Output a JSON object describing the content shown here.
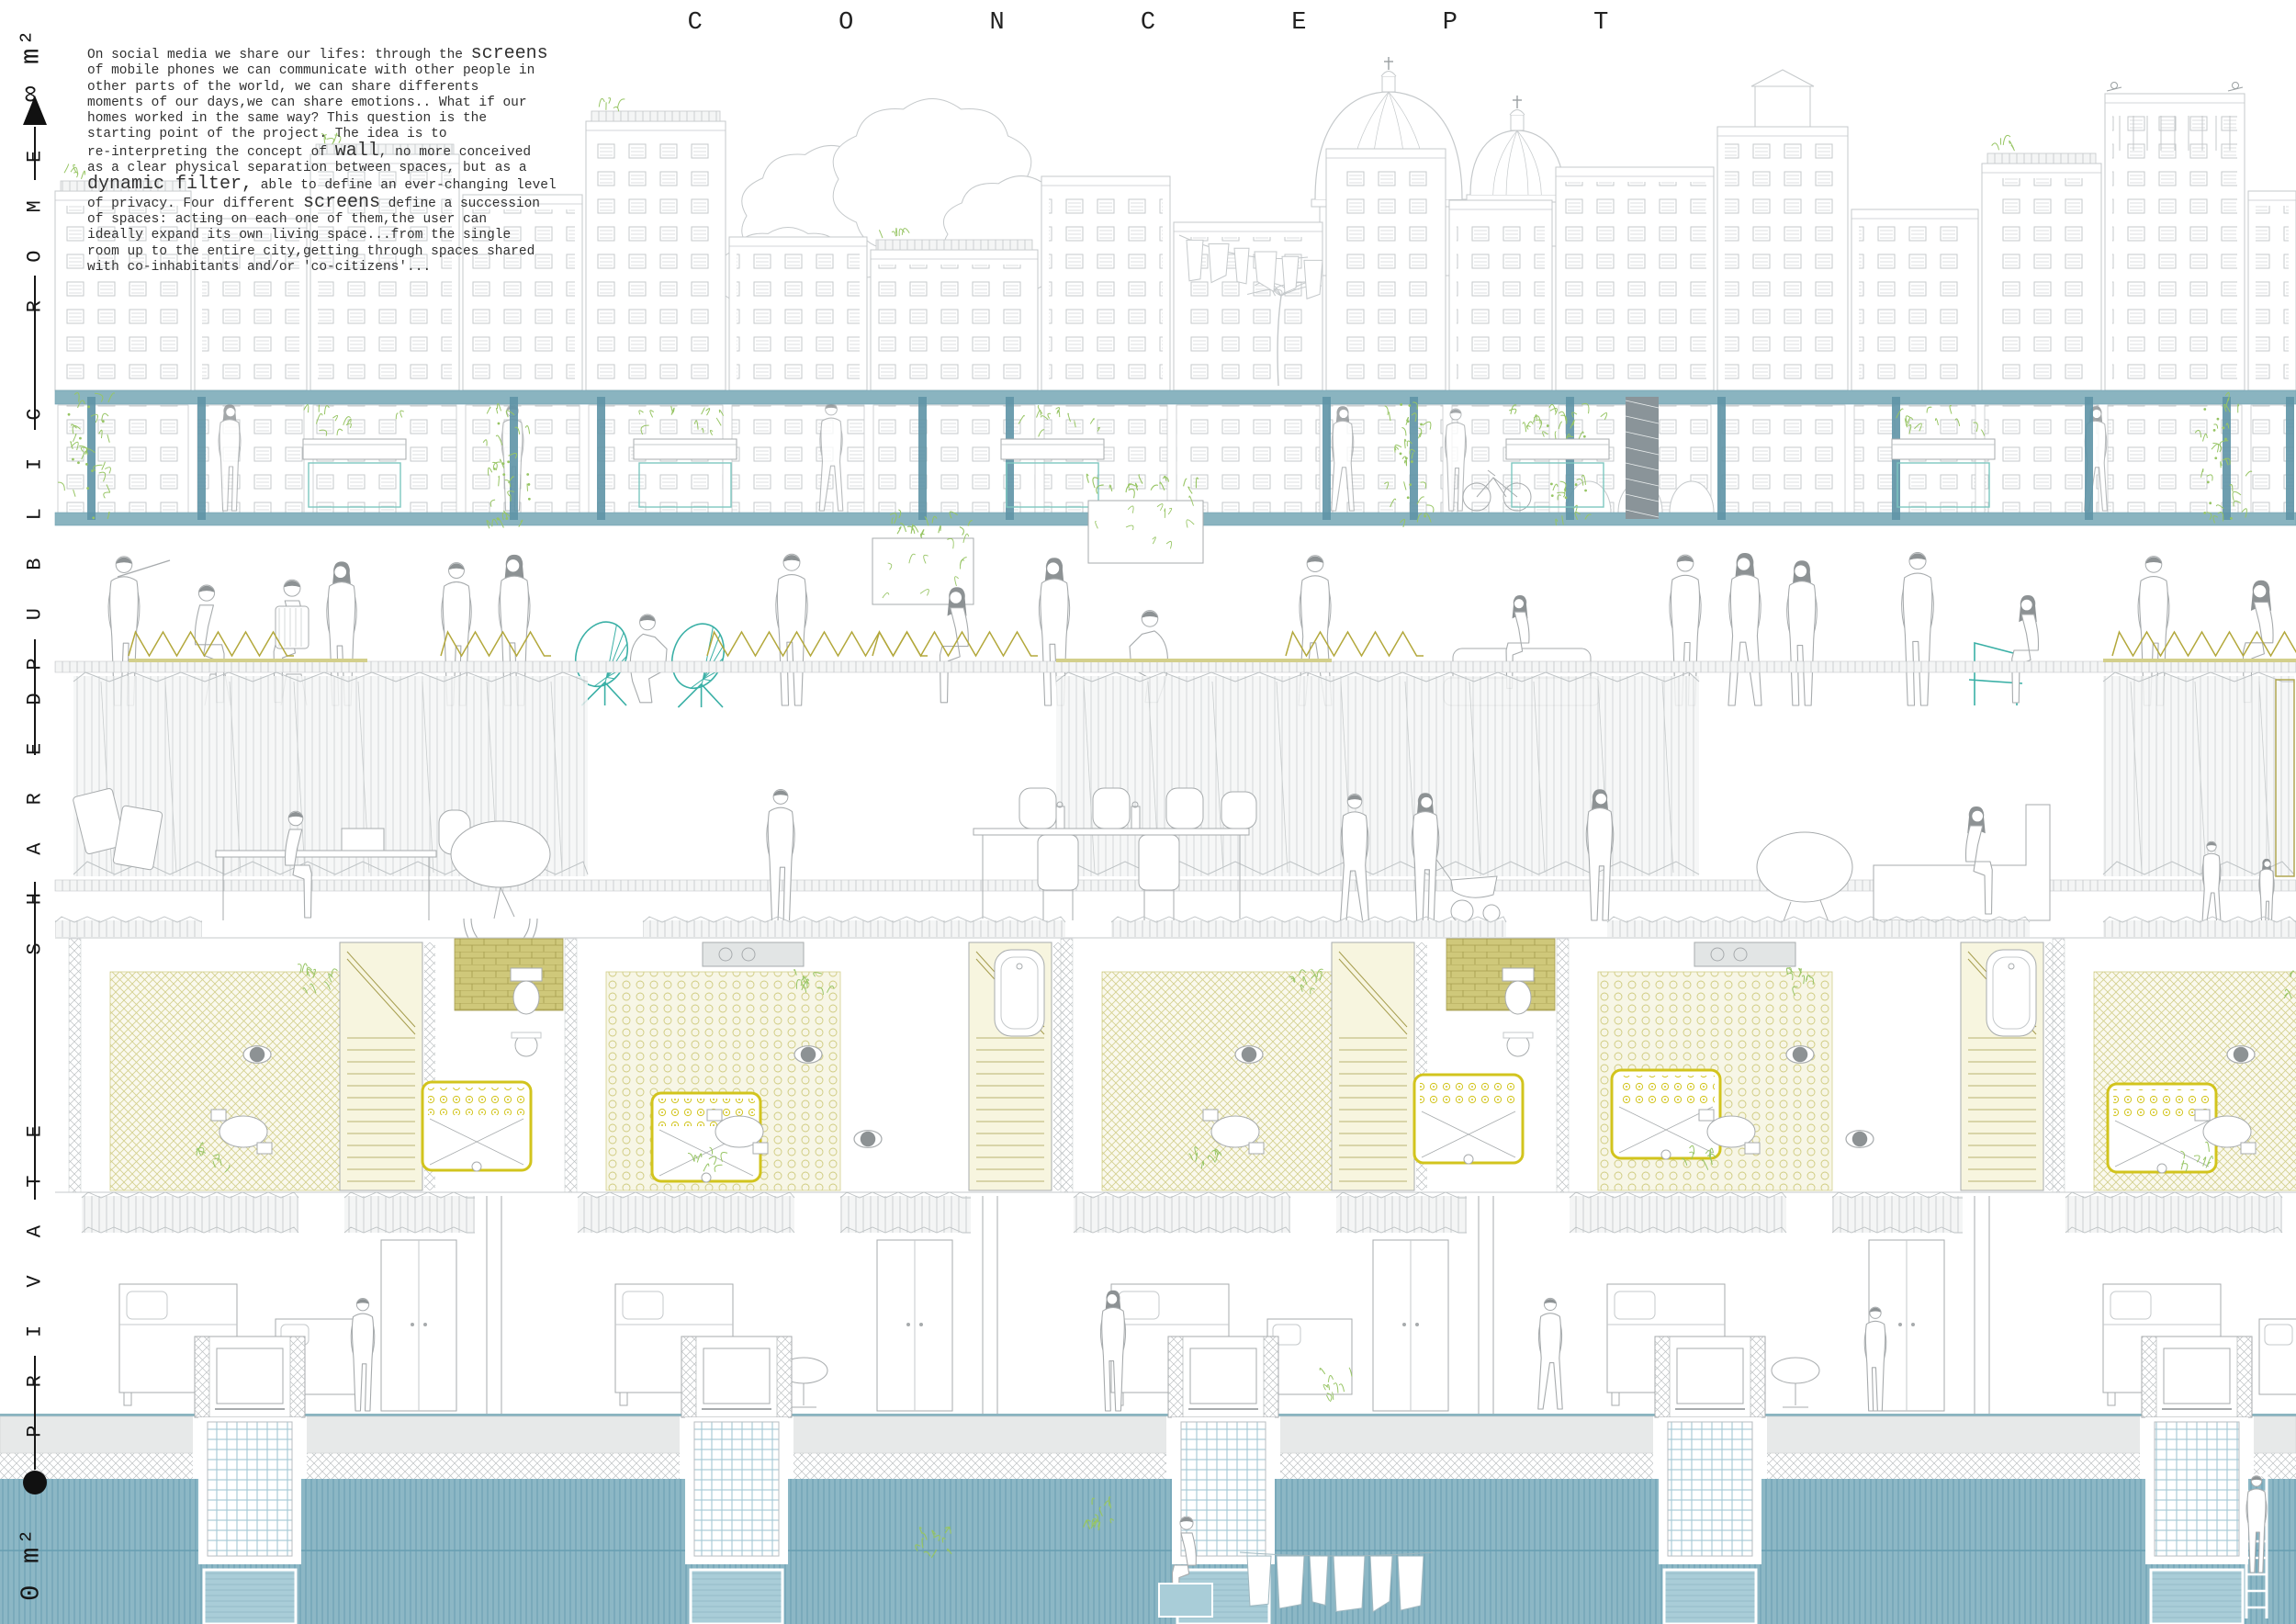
{
  "title": "C O N C E P T",
  "axis": {
    "infinity_label": "∞ m²",
    "zero_label": "0 m²",
    "levels": [
      "R O M E",
      "P U B L I C",
      "S H A R E D",
      "P R I V A T E"
    ]
  },
  "concept_text": {
    "segments": [
      {
        "text": "On social media we share our lifes: through the ",
        "big": false
      },
      {
        "text": "screens",
        "big": true
      },
      {
        "text": "\nof mobile phones we can communicate with other people in\nother parts of the world, we can share differents\nmoments of our days,we can share emotions.. What if our\nhomes worked in the same way? This question is the\nstarting point of the project. The idea is to\nre-interpreting the concept of ",
        "big": false
      },
      {
        "text": "wall",
        "big": true
      },
      {
        "text": ", no more conceived\nas a clear physical separation between spaces, but as a\n",
        "big": false
      },
      {
        "text": "dynamic filter,",
        "big": true
      },
      {
        "text": " able to define an ever-changing level\nof privacy. Four different ",
        "big": false
      },
      {
        "text": "screens",
        "big": true
      },
      {
        "text": " define a succession\nof spaces: acting on each one of them,the user can\nideally expand its own living space...from the single\nroom up to the entire city,getting through spaces shared\nwith co-inhabitants and/or 'co-citizens'...",
        "big": false
      }
    ]
  },
  "colors": {
    "ink": "#2e2e2e",
    "line_light": "#c5c9cb",
    "line_mid": "#a7abad",
    "hair_gray": "#8d9294",
    "teal_beam": "#8ab4c0",
    "teal_dark": "#5e93a6",
    "teal_chair": "#3ab0a6",
    "plant_green": "#97c564",
    "olive": "#b3a83c",
    "olive_light": "#d3cf8c",
    "bed_yellow": "#d2c41d",
    "water": "#8cb7c5",
    "water_line": "#679eb1",
    "water_panel": "#a9cdd8",
    "grid_blue": "#a9cbd7",
    "strip_gray": "#e7e9e9"
  }
}
